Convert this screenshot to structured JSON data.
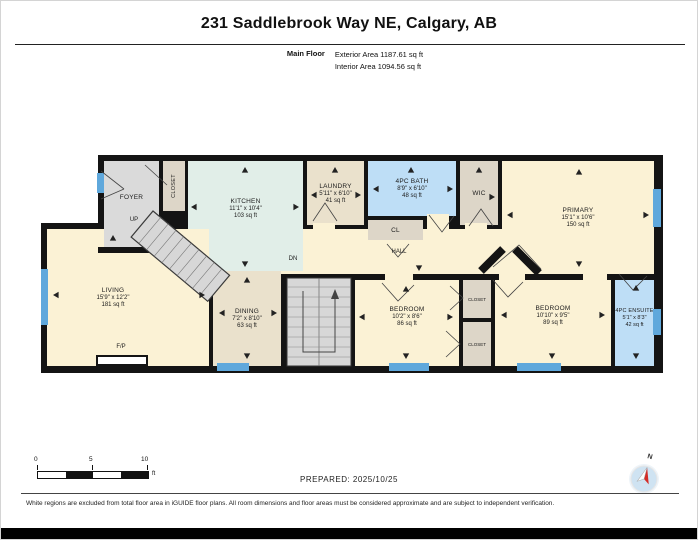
{
  "header": {
    "title": "231 Saddlebrook Way NE, Calgary, AB",
    "floor_label": "Main Floor",
    "exterior_area": "Exterior Area 1187.61 sq ft",
    "interior_area": "Interior Area 1094.56 sq ft"
  },
  "plan": {
    "rooms": {
      "foyer": {
        "name": "FOYER"
      },
      "foyer_closet": {
        "name": "CLOSET"
      },
      "kitchen": {
        "name": "KITCHEN",
        "dims": "11'1\" x 10'4\"",
        "area": "103 sq ft"
      },
      "laundry": {
        "name": "LAUNDRY",
        "dims": "5'11\" x 6'10\"",
        "area": "41 sq ft"
      },
      "bath": {
        "name": "4PC BATH",
        "dims": "8'9\" x 6'10\"",
        "area": "48 sq ft"
      },
      "wic": {
        "name": "WIC"
      },
      "primary": {
        "name": "PRIMARY",
        "dims": "15'1\" x 10'6\"",
        "area": "150 sq ft"
      },
      "cl": {
        "name": "CL"
      },
      "hall": {
        "name": "HALL"
      },
      "living": {
        "name": "LIVING",
        "dims": "15'9\" x 12'2\"",
        "area": "181 sq ft"
      },
      "dining": {
        "name": "DINING",
        "dims": "7'2\" x 8'10\"",
        "area": "63 sq ft"
      },
      "bedroom1": {
        "name": "BEDROOM",
        "dims": "10'2\" x 8'6\"",
        "area": "86 sq ft"
      },
      "closet1": {
        "name": "CLOSET"
      },
      "closet2": {
        "name": "CLOSET"
      },
      "bedroom2": {
        "name": "BEDROOM",
        "dims": "10'10\" x 9'5\"",
        "area": "89 sq ft"
      },
      "ensuite": {
        "name": "4PC ENSUITE",
        "dims": "5'1\" x 8'3\"",
        "area": "42 sq ft"
      }
    },
    "labels": {
      "up": "UP",
      "dn": "DN",
      "fireplace": "F/P"
    }
  },
  "scale_bar": {
    "t0": "0",
    "t5": "5",
    "t10": "10",
    "unit": "ft"
  },
  "footer": {
    "prepared": "PREPARED: 2025/10/25",
    "disclaimer": "White regions are excluded from total floor area in iGUIDE floor plans. All room dimensions and floor areas must be considered approximate and are subject to independent verification."
  },
  "compass": {
    "label": "N"
  },
  "colors": {
    "wall": "#141414",
    "room_cream": "#FBF2D5",
    "room_tan": "#EAE1CC",
    "room_tan_dark": "#DDD6C8",
    "room_mint": "#E1EEE8",
    "room_blue": "#BEDEF6",
    "room_gray": "#DADADA",
    "window_blue": "#5FA8DC",
    "compass_needle_red": "#D42B26"
  }
}
